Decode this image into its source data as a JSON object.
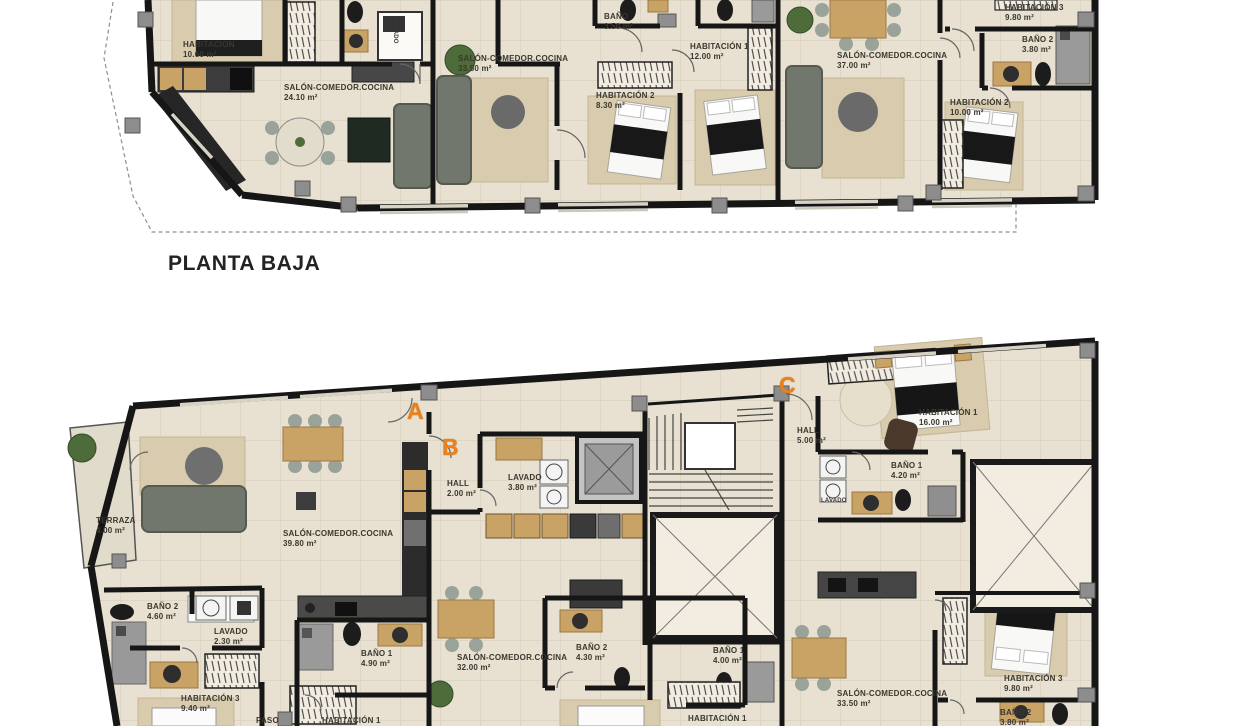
{
  "sheet": {
    "background": "#ffffff",
    "title_bottom_plan": ""
  },
  "colors": {
    "wall": "#161616",
    "floor": "#e8e1d1",
    "terrace_floor": "#e0dbcb",
    "accent_unit_letters": "#e8821f",
    "wood": "#c9a266",
    "sofa": "#71776d",
    "patio_fill": "#f2ede0",
    "pillar": "#8d8d8d",
    "dashed_boundary": "#8f8f8f",
    "label_text": "#3a372e"
  },
  "plan_top": {
    "title": "PLANTA BAJA",
    "rooms": [
      {
        "label": "HABITACION",
        "area": "10.60 m²"
      },
      {
        "label": "BAÑO",
        "area": "3.50 m²"
      },
      {
        "label": "LAVADO",
        "area": ""
      },
      {
        "label": "SALÓN-COMEDOR.COCINA",
        "area": "24.10 m²"
      },
      {
        "label": "SALÓN-COMEDOR.COCINA",
        "area": "33.50 m²"
      },
      {
        "label": "HABITACIÓN 2",
        "area": "8.30 m²"
      },
      {
        "label": "HABITACIÓN 1",
        "area": "12.00 m²"
      },
      {
        "label": "SALÓN-COMEDOR.COCINA",
        "area": "37.00 m²"
      },
      {
        "label": "HABITACIÓN 2",
        "area": "10.00 m²"
      },
      {
        "label": "HABITACIÓN 3",
        "area": "9.80 m²"
      },
      {
        "label": "BAÑO 2",
        "area": "3.80 m²"
      }
    ]
  },
  "plan_bottom": {
    "units": [
      "A",
      "B",
      "C"
    ],
    "rooms": [
      {
        "label": "TERRAZA",
        "area": "4.00 m²"
      },
      {
        "label": "SALÓN-COMEDOR.COCINA",
        "area": "39.80 m²"
      },
      {
        "label": "HALL",
        "area": "2.00 m²"
      },
      {
        "label": "LAVADO",
        "area": "3.80 m²"
      },
      {
        "label": "BAÑO 2",
        "area": "4.60 m²"
      },
      {
        "label": "LAVADO",
        "area": "2.30 m²"
      },
      {
        "label": "HABITACIÓN 3",
        "area": "9.40 m²"
      },
      {
        "label": "BAÑO 1",
        "area": "4.90 m²"
      },
      {
        "label": "PASO",
        "area": ""
      },
      {
        "label": "HABITACIÓN 1",
        "area": ""
      },
      {
        "label": "SALÓN-COMEDOR.COCINA",
        "area": "32.00 m²"
      },
      {
        "label": "BAÑO 2",
        "area": "4.30 m²"
      },
      {
        "label": "BAÑO 1",
        "area": "4.00 m²"
      },
      {
        "label": "HABITACIÓN 1",
        "area": ""
      },
      {
        "label": "HALL",
        "area": "5.00 m²"
      },
      {
        "label": "HABITACIÓN 1",
        "area": "16.00 m²"
      },
      {
        "label": "BAÑO 1",
        "area": "4.20 m²"
      },
      {
        "label": "LAVADO",
        "area": ""
      },
      {
        "label": "SALÓN-COMEDOR.COCINA",
        "area": "33.50 m²"
      },
      {
        "label": "HABITACIÓN 3",
        "area": "9.80 m²"
      },
      {
        "label": "BAÑO 2",
        "area": "3.80 m²"
      }
    ]
  }
}
